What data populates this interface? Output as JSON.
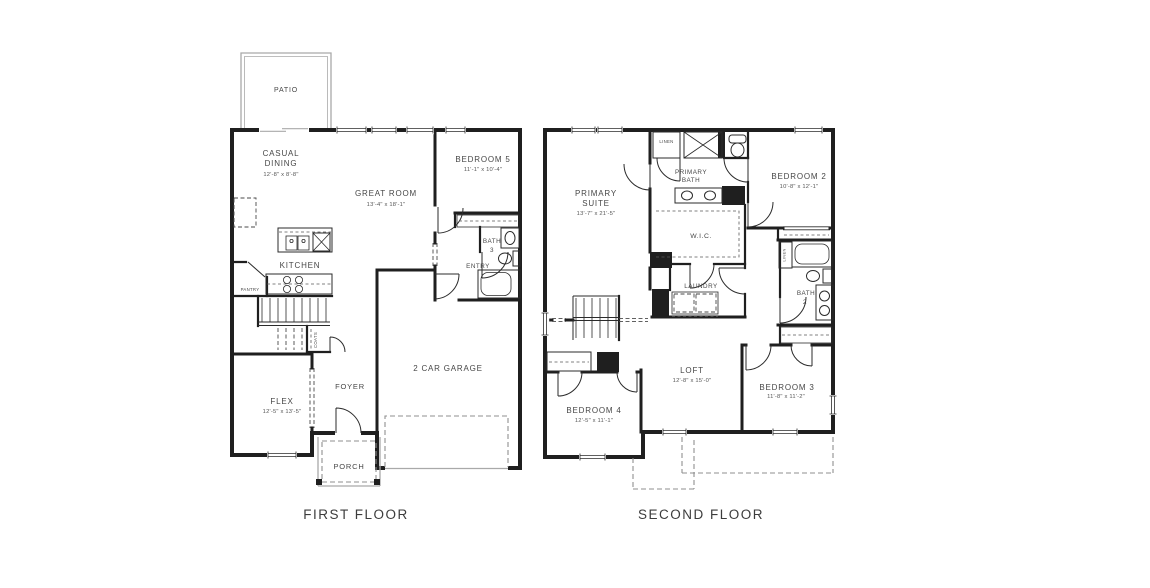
{
  "palette": {
    "background": "#ffffff",
    "wall": "#1f1f1f",
    "light_line": "#a9a9a9",
    "dashed_line": "#8f8f8f",
    "text": "#474747"
  },
  "first_floor": {
    "label": "FIRST FLOOR",
    "rooms": {
      "patio": {
        "name": "PATIO"
      },
      "casual_dining": {
        "line1": "CASUAL",
        "line2": "DINING",
        "dims": "12'-8\" x 8'-8\""
      },
      "great_room": {
        "name": "GREAT ROOM",
        "dims": "13'-4\" x 18'-1\""
      },
      "bedroom_5": {
        "name": "BEDROOM 5",
        "dims": "11'-1\" x 10'-4\""
      },
      "kitchen": {
        "name": "KITCHEN"
      },
      "pantry": {
        "name": "PANTRY"
      },
      "bath_3": {
        "line1": "BATH",
        "line2": "3"
      },
      "entry": {
        "name": "ENTRY"
      },
      "coats_closet": {
        "name": "COATS"
      },
      "flex": {
        "name": "FLEX",
        "dims": "12'-5\" x 13'-5\""
      },
      "foyer": {
        "name": "FOYER"
      },
      "garage": {
        "name": "2 CAR GARAGE"
      },
      "porch": {
        "name": "PORCH"
      }
    }
  },
  "second_floor": {
    "label": "SECOND FLOOR",
    "rooms": {
      "primary_suite": {
        "line1": "PRIMARY",
        "line2": "SUITE",
        "dims": "13'-7\" x 21'-5\""
      },
      "linen": {
        "name": "LINEN"
      },
      "primary_bath": {
        "line1": "PRIMARY",
        "line2": "BATH"
      },
      "bedroom_2": {
        "name": "BEDROOM 2",
        "dims": "10'-8\" x 12'-1\""
      },
      "wic": {
        "name": "W.I.C."
      },
      "laundry": {
        "name": "LAUNDRY"
      },
      "linen_2": {
        "name": "LINEN"
      },
      "bath_2": {
        "line1": "BATH",
        "line2": "2"
      },
      "bedroom_4": {
        "name": "BEDROOM 4",
        "dims": "12'-5\" x 11'-1\""
      },
      "loft": {
        "name": "LOFT",
        "dims": "12'-8\" x 15'-0\""
      },
      "bedroom_3": {
        "name": "BEDROOM 3",
        "dims": "11'-8\" x 11'-2\""
      }
    }
  }
}
